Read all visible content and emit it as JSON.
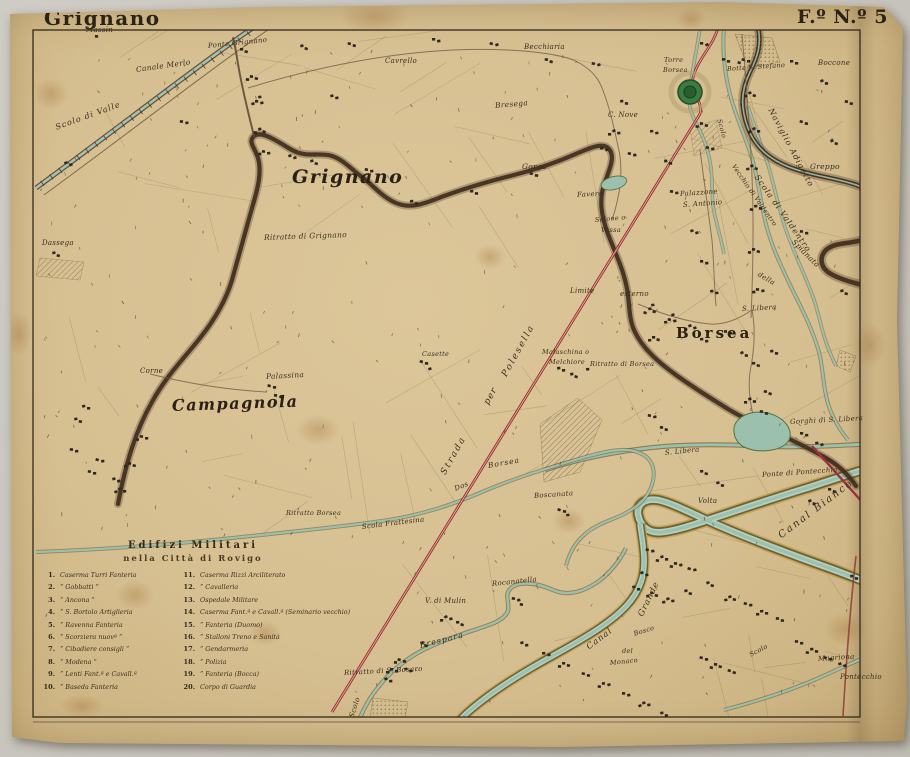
{
  "titles": {
    "sheet_name": "Grignano",
    "sheet_number": "F.º N.º 5"
  },
  "colors": {
    "paper": "#d6bf91",
    "ink": "#3a2e1f",
    "road_red": "#a03044",
    "water_teal": "#9cc0ae",
    "river_brown": "#453122",
    "tower_green": "#3b7a41",
    "canal_gold": "#c8a23c"
  },
  "labels": {
    "map_grignano": "Grignano",
    "map_campagnola": "Campagnola",
    "map_borsea": "Borsea",
    "massin": "Massin",
    "ponte_grignano": "Ponte Grignano",
    "canale_merlo": "Canale Merlo",
    "scolo_di_valle": "Scolo di Valle",
    "cavrello": "Cavrello",
    "becchiaria": "Becchiaria",
    "torre": "Torre",
    "torre2": "Borsea",
    "botte_s_stefano": "Botte S. Stefano",
    "boccone": "Boccone",
    "greppo": "Greppo",
    "naviglio_adigetto": "Naviglio Adigetto",
    "scola_di_valdentro": "Scola di Valdentro",
    "vecchio_di_valdentro": "Vecchio di Valdentro",
    "scolo_torre": "Scolo",
    "spianata": "Spianata",
    "della": "della",
    "bresega": "Bresega",
    "c_nove": "C. Nove",
    "gorga": "Gorga",
    "favero": "Favero",
    "selone_1": "Selone o",
    "selone_2": "Vessa",
    "palazzone_1": "Palazzone",
    "palazzone_2": "S. Antonio",
    "limite": "Limite",
    "esterno": "esterno",
    "ritratto_di_borsea": "Ritratto di Borsea",
    "malaschina_1": "Malaschina o",
    "malaschina_2": "Melchiore",
    "casette": "Casette",
    "ritratto_di_grignano": "Ritratto di Grignano",
    "dassega": "Dassega",
    "corne": "Corne",
    "palassina": "Palassina",
    "s_libera_1": "S. Libera",
    "s_libera_2": "S. Libera",
    "gorghi": "Gorghi di S. Libera",
    "ponte_di_pontecchio": "Ponte di Pontecchio",
    "volta": "Volta",
    "canal_bianco": "Canal Bianco",
    "canal_grande_1": "Canal",
    "canal_grande_2": "Grande",
    "bosco": "Bosco",
    "del": "del",
    "monaco": "Monaco",
    "magriona": "Magriona",
    "pontecchio": "Pontecchio",
    "scolo_2": "Scolo",
    "boscanata": "Boscanata",
    "rocanatella": "Rocanatella",
    "v_di_mulin": "V. di Mulin",
    "brespara": "Brespara",
    "scolo_3": "Scolo",
    "ritratto_di_s_bosaro": "Ritratto di S. Bosaro",
    "scola_frattesina": "Scola Frattesina",
    "dos": "Dos",
    "borsea_stream": "Borsea",
    "strada": "Strada",
    "per": "per",
    "polesella": "Polesella",
    "ritratto_borsea2": "Ritratto Borsea"
  },
  "legend": {
    "title_line1": "Edifizi Militari",
    "title_line2": "nella Città di Rovigo",
    "left": [
      {
        "n": "1.",
        "t": "Caserma Turri Fanteria"
      },
      {
        "n": "2.",
        "t": "”  Gobbatti  ”"
      },
      {
        "n": "3.",
        "t": "”  Ancona  ”"
      },
      {
        "n": "4.",
        "t": "”  S. Bortolo Artiglieria"
      },
      {
        "n": "5.",
        "t": "”  Ravenna  Fanteria"
      },
      {
        "n": "6.",
        "t": "”  Scorziera nuovª  ”"
      },
      {
        "n": "7.",
        "t": "”  Cibadiere consigli  ”"
      },
      {
        "n": "8.",
        "t": "”  Modena  ”"
      },
      {
        "n": "9.",
        "t": "”  Lenti Fant.ª e Cavall.ª"
      },
      {
        "n": "10.",
        "t": "”  Baseda Fanteria"
      }
    ],
    "right": [
      {
        "n": "11.",
        "t": "Caserma Rizzi Arciliterato"
      },
      {
        "n": "12.",
        "t": "”  Cavalleria"
      },
      {
        "n": "13.",
        "t": "Ospedale Militare"
      },
      {
        "n": "14.",
        "t": "Caserma Fant.ª e Cavall.ª (Seminario vecchio)"
      },
      {
        "n": "15.",
        "t": "”  Fanteria (Duomo)"
      },
      {
        "n": "16.",
        "t": "”  Stalloni Treno e Sanità"
      },
      {
        "n": "17.",
        "t": "”  Gendarmeria"
      },
      {
        "n": "18.",
        "t": "”  Polizia"
      },
      {
        "n": "19.",
        "t": "”  Fanteria (Bocca)"
      },
      {
        "n": "20.",
        "t": "Corpo di Guardia"
      }
    ]
  }
}
